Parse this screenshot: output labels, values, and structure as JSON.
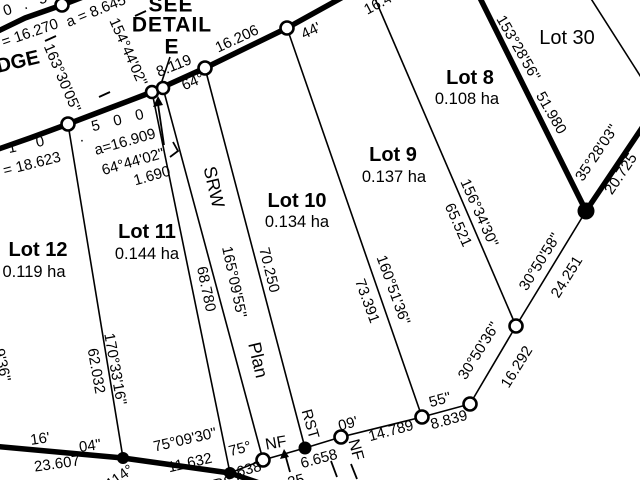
{
  "colors": {
    "ink": "#000000",
    "paper": "#ffffff"
  },
  "detail_note": {
    "l1": "SEE",
    "l2": "DETAIL",
    "l3": "E"
  },
  "lots": {
    "lot8": {
      "name": "Lot 8",
      "area": "0.108 ha"
    },
    "lot9": {
      "name": "Lot 9",
      "area": "0.137 ha"
    },
    "lot10": {
      "name": "Lot 10",
      "area": "0.134 ha"
    },
    "lot11": {
      "name": "Lot 11",
      "area": "0.144 ha"
    },
    "lot12": {
      "name": "Lot 12",
      "area": "0.119 ha"
    },
    "lot30": {
      "name": "Lot 30"
    }
  },
  "road": {
    "name_fragment": "DGE",
    "chainage_fragments": {
      "top": "0 . 5",
      "mid": "5 0 0",
      "left": "1 0",
      "dot": "."
    },
    "arc_lengths": {
      "a1": "a = 8.645",
      "a2": "= 16.270",
      "a3": "a=16.909",
      "a4": "= 18.623"
    },
    "radial_bearings": {
      "r1": "163°30'05\"",
      "r2": "154°44'02\""
    },
    "frontage": {
      "d1": "8.119",
      "d2": "16.206",
      "d3": "16.4",
      "b1": "64°",
      "b2": "44'"
    },
    "srw_leader": {
      "bearing": "64°44'02\"",
      "width": "1.690"
    }
  },
  "boundaries": {
    "lot12_lot11": {
      "bearing": "170°33'16\"",
      "dist": "62.032"
    },
    "srw_strip": {
      "label1": "SRW",
      "label2": "Plan",
      "label3": "RST",
      "bearing": "165°09'55\"",
      "dist_left": "68.780",
      "dist_right": "70.250"
    },
    "lot10_lot9": {
      "bearing": "160°51'36\"",
      "dist": "73.391"
    },
    "lot9_lot8": {
      "bearing": "156°34'30\"",
      "dist": "65.521"
    },
    "lot8_lot30": {
      "bearing": "153°28'56\"",
      "dist": "51.980"
    },
    "northeast": {
      "bearing": "35°28'03\"",
      "dist": "20.725"
    }
  },
  "south_chain": {
    "seg1": {
      "bearing": "30°50'58\"",
      "dist": "24.251"
    },
    "seg2": {
      "bearing": "30°50'36\"",
      "dist": "16.292"
    },
    "seg3": {
      "bearing": "55\"",
      "dist": "8.839"
    },
    "seg4": {
      "bearing": "09'",
      "dist": "14.789"
    },
    "seg5": {
      "bearing": "75°",
      "dist": "6.638"
    },
    "seg6": {
      "dist": "6.658"
    },
    "seg7": {
      "bearing": "75°09'30\"",
      "dist": "11.632"
    },
    "seg8": {
      "bearing_min": "16'",
      "bearing_sec": "04\"",
      "dist": "23.607"
    },
    "nf_left": "NF",
    "nf_right": "NF"
  },
  "edge_fragments": {
    "bearing_114": "114°",
    "rst_bottom": "RST",
    "frag_25": "25",
    "left_seconds": "9'36\""
  }
}
